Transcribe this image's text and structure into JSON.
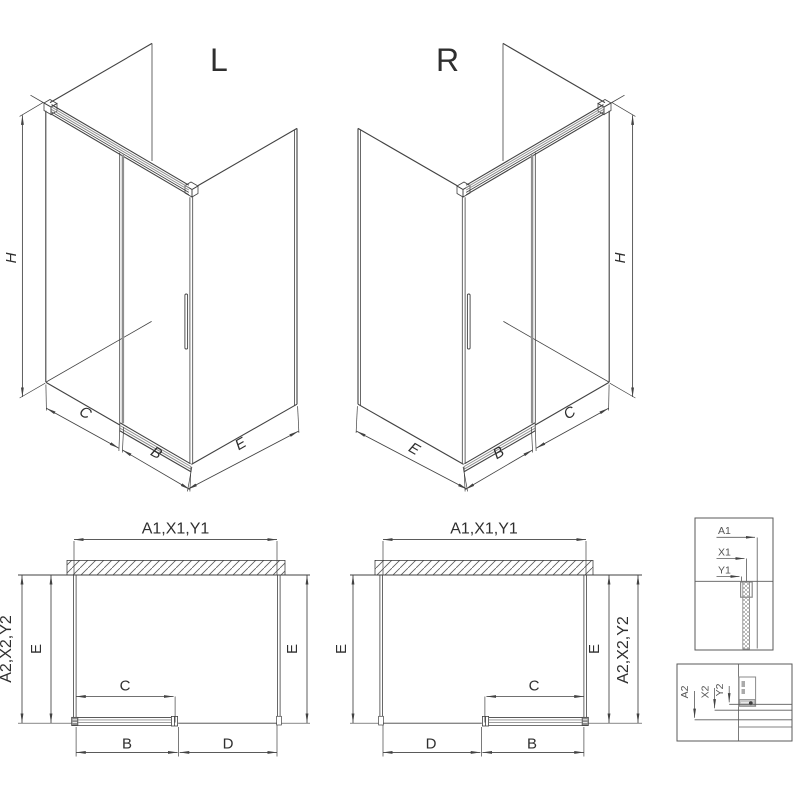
{
  "colors": {
    "line": "#424242",
    "profile_gray": "#8f8f8f",
    "detail_line": "#5a5a5a",
    "background": "#ffffff"
  },
  "iso_left": {
    "label": "L",
    "height_dim": "H",
    "fixed_dim": "C",
    "door_dim": "B",
    "side_dim": "E"
  },
  "iso_right": {
    "label": "R",
    "height_dim": "H",
    "fixed_dim": "C",
    "door_dim": "B",
    "side_dim": "E"
  },
  "plan_left": {
    "width_dim": "A1,X1,Y1",
    "depth_outer_dim": "A2,X2,Y2",
    "side_left_dim": "E",
    "side_right_dim": "E",
    "opening_dim": "C",
    "door_dim": "B",
    "fixed_dim": "D"
  },
  "plan_right": {
    "width_dim": "A1,X1,Y1",
    "depth_outer_dim": "A2,X2,Y2",
    "side_left_dim": "E",
    "side_right_dim": "E",
    "opening_dim": "C",
    "door_dim": "B",
    "fixed_dim": "D"
  },
  "detail_top": {
    "labels": [
      "A1",
      "X1",
      "Y1"
    ]
  },
  "detail_bottom": {
    "labels": [
      "A2",
      "X2",
      "Y2"
    ]
  }
}
